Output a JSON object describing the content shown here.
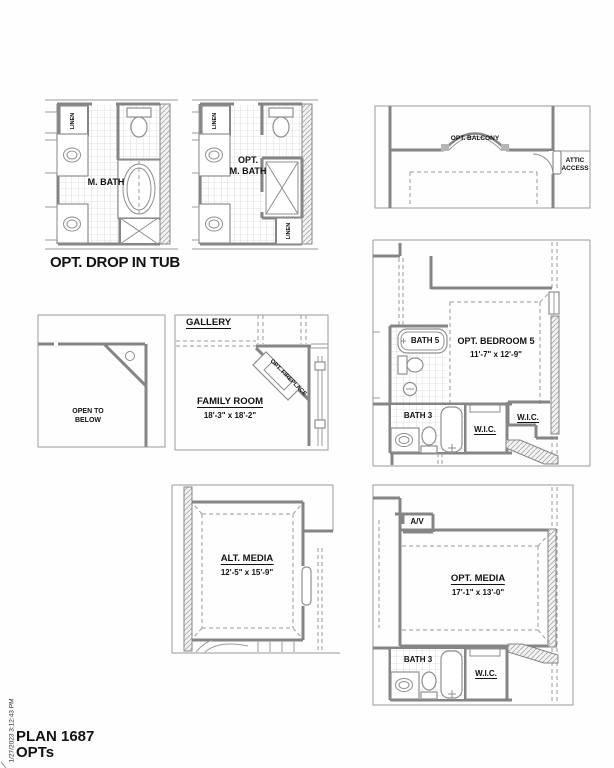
{
  "footer": {
    "plan": "PLAN 1687",
    "subtitle": "OPTs",
    "timestamp": "1/27/2023 3:12:43 PM"
  },
  "colors": {
    "wall": "#858585",
    "thin_line": "#9b9b9b",
    "text": "#121212"
  },
  "plans": {
    "master_bath": {
      "room": "M. BATH",
      "linen": "LINEN",
      "caption": "OPT. DROP IN TUB"
    },
    "opt_master_bath": {
      "room_line1": "OPT.",
      "room_line2": "M. BATH",
      "linen_top": "LINEN",
      "linen_bottom": "LINEN"
    },
    "balcony": {
      "label": "OPT. BALCONY",
      "attic_line1": "ATTIC",
      "attic_line2": "ACCESS"
    },
    "open_to_below": {
      "line1": "OPEN TO",
      "line2": "BELOW"
    },
    "family_room": {
      "gallery": "GALLERY",
      "room": "FAMILY ROOM",
      "dims": "18'-3\" x 18'-2\"",
      "fireplace": "OPT. FIREPLACE"
    },
    "bedroom5": {
      "bath5": "BATH 5",
      "room": "OPT. BEDROOM 5",
      "dims": "11'-7\" x 12'-9\"",
      "bath3": "BATH 3",
      "wic_center": "W.I.C.",
      "wic_right": "W.I.C."
    },
    "alt_media": {
      "room": "ALT. MEDIA",
      "dims": "12'-5\" x 15'-9\""
    },
    "opt_media": {
      "av": "A/V",
      "room": "OPT. MEDIA",
      "dims": "17'-1\" x 13'-0\"",
      "bath3": "BATH 3",
      "wic": "W.I.C."
    }
  }
}
